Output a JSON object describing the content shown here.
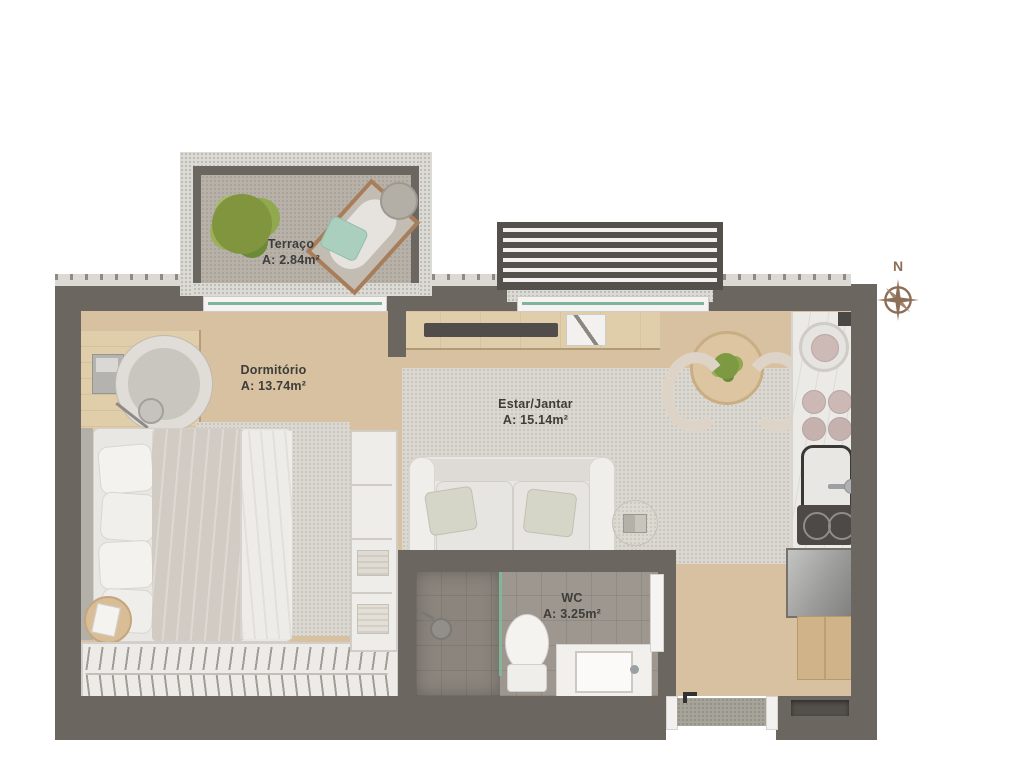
{
  "plan": {
    "rooms": {
      "terrace": {
        "name": "Terraço",
        "area": "A: 2.84m²"
      },
      "bedroom": {
        "name": "Dormitório",
        "area": "A: 13.74m²"
      },
      "living": {
        "name": "Estar/Jantar",
        "area": "A: 15.14m²"
      },
      "wc": {
        "name": "WC",
        "area": "A: 3.25m²"
      }
    },
    "compass": {
      "north_label": "N"
    },
    "colors": {
      "wall": "#6c6661",
      "wood_floor": "#d7c1a1",
      "rug": "#dbd8d1",
      "terrace_floor": "#b7b1a8",
      "wc_floor": "#9d978f",
      "glass_green": "#7fb49b",
      "compass_brown": "#8d6f59"
    }
  }
}
